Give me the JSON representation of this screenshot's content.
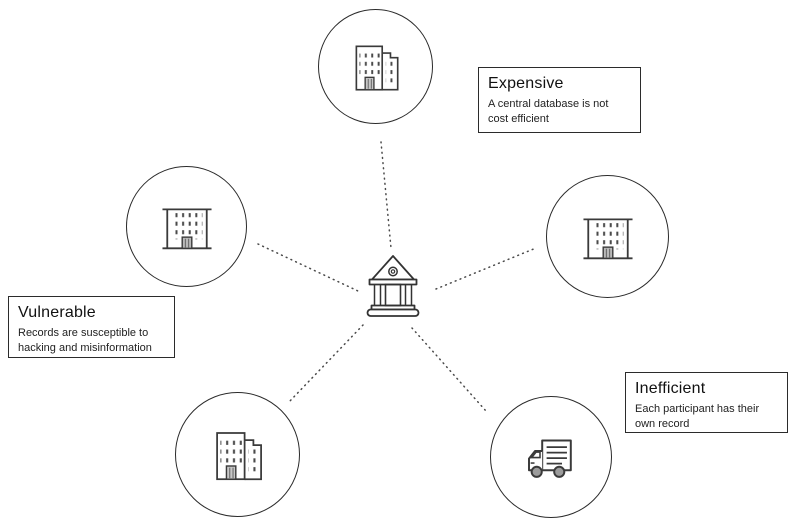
{
  "colors": {
    "background": "#ffffff",
    "outline": "#2b2b2b",
    "icon_stroke": "#3a3a3a",
    "dotted_line": "#4a4a4a",
    "text": "#1a1a1a"
  },
  "center": {
    "icon": "bank-icon"
  },
  "nodes": [
    {
      "id": "top",
      "icon": "building-two-towers-icon"
    },
    {
      "id": "left",
      "icon": "building-flat-roof-icon"
    },
    {
      "id": "right",
      "icon": "building-flat-roof-icon"
    },
    {
      "id": "bottom-left",
      "icon": "building-two-towers-icon"
    },
    {
      "id": "bottom-right",
      "icon": "delivery-truck-icon"
    }
  ],
  "callouts": {
    "expensive": {
      "title": "Expensive",
      "description": "A central database is not cost efficient"
    },
    "vulnerable": {
      "title": "Vulnerable",
      "description": "Records are susceptible to hacking and misinformation"
    },
    "inefficient": {
      "title": "Inefficient",
      "description": "Each participant has their own record"
    }
  }
}
